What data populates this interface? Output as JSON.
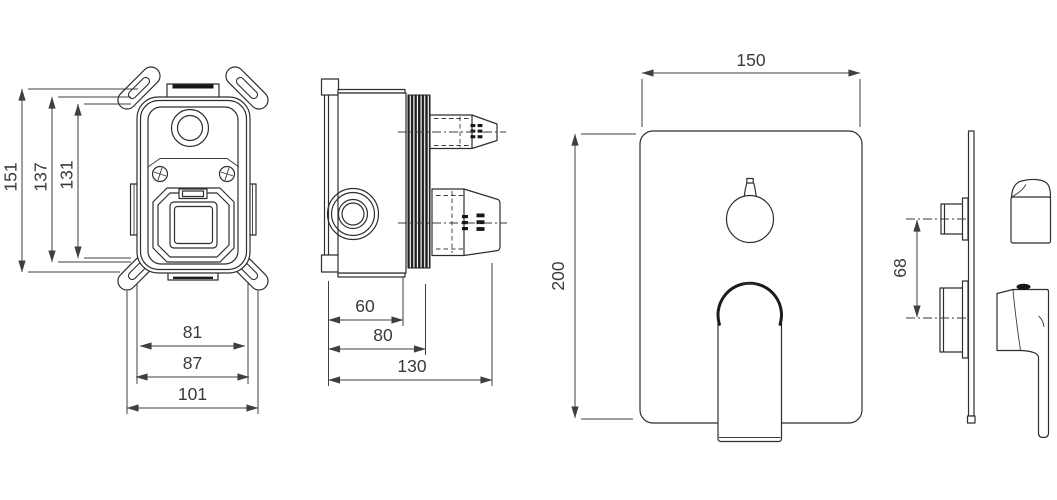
{
  "drawing": {
    "background": "#ffffff",
    "line_color": "#2e2e2e",
    "dim_color": "#3f3f3f",
    "views": {
      "box_front": {
        "dims": {
          "h_overall": "151",
          "h_mount": "137",
          "h_inner": "131",
          "w_inner": "81",
          "w_mount": "87",
          "w_overall": "101"
        }
      },
      "box_side": {
        "dims": {
          "d_front": "60",
          "d_mid": "80",
          "d_overall": "130"
        }
      },
      "trim_front": {
        "dims": {
          "width": "150",
          "height": "200"
        }
      },
      "trim_side": {
        "dims": {
          "handle_spacing": "68"
        }
      }
    }
  }
}
